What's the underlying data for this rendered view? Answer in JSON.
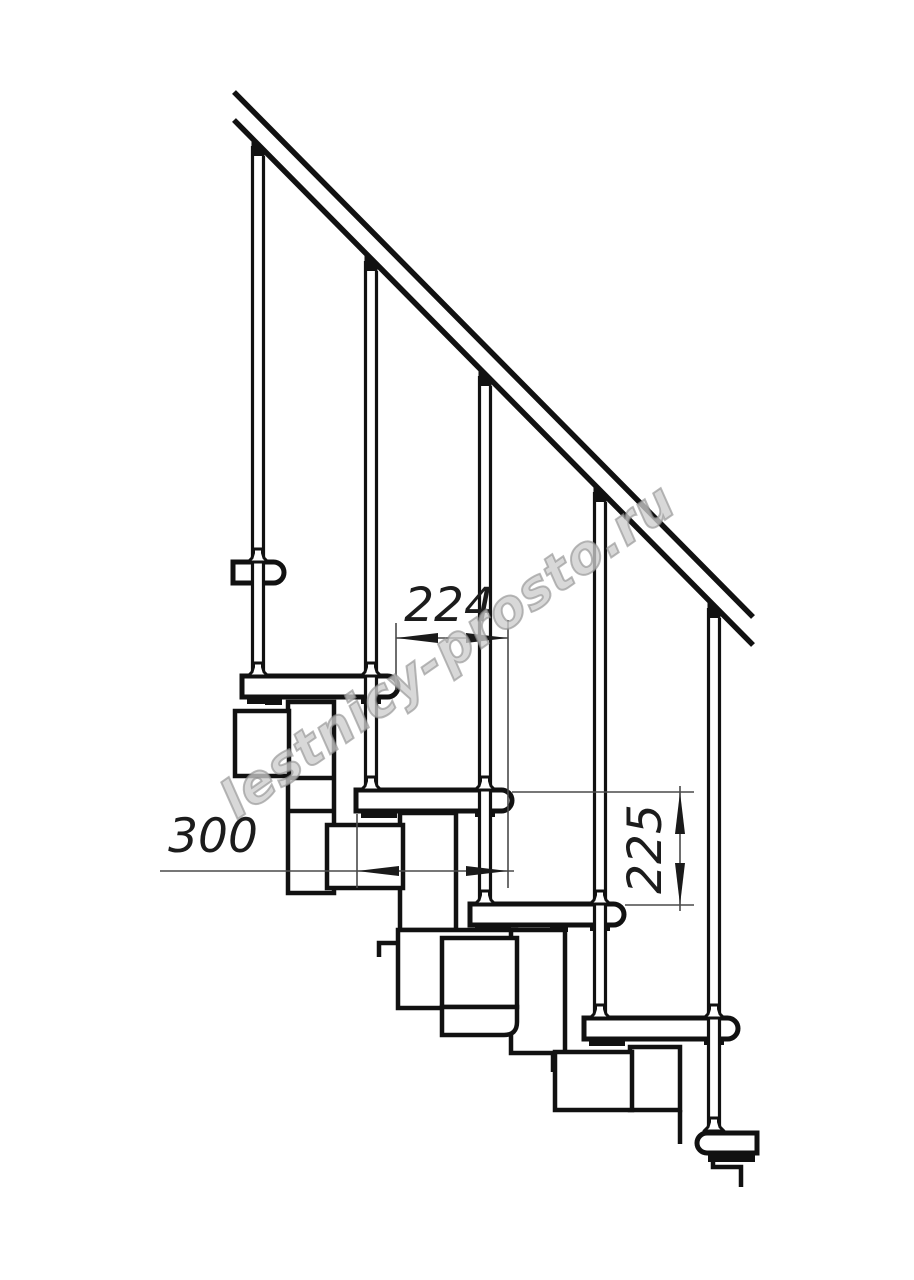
{
  "figure": {
    "type": "technical-drawing",
    "subject": "modular staircase side elevation",
    "treads_depicted": 6,
    "balusters_depicted": 5
  },
  "dimensions": {
    "going": {
      "label": "224"
    },
    "tread_depth": {
      "label": "300"
    },
    "rise": {
      "label": "225"
    }
  },
  "watermark": {
    "text": "lestnicy-prosto.ru"
  },
  "colors": {
    "line": "#111111",
    "dimension_line": "#4a4a4a",
    "background": "#ffffff",
    "watermark_stroke": "#919191",
    "watermark_fill": "#e4e4e4"
  }
}
